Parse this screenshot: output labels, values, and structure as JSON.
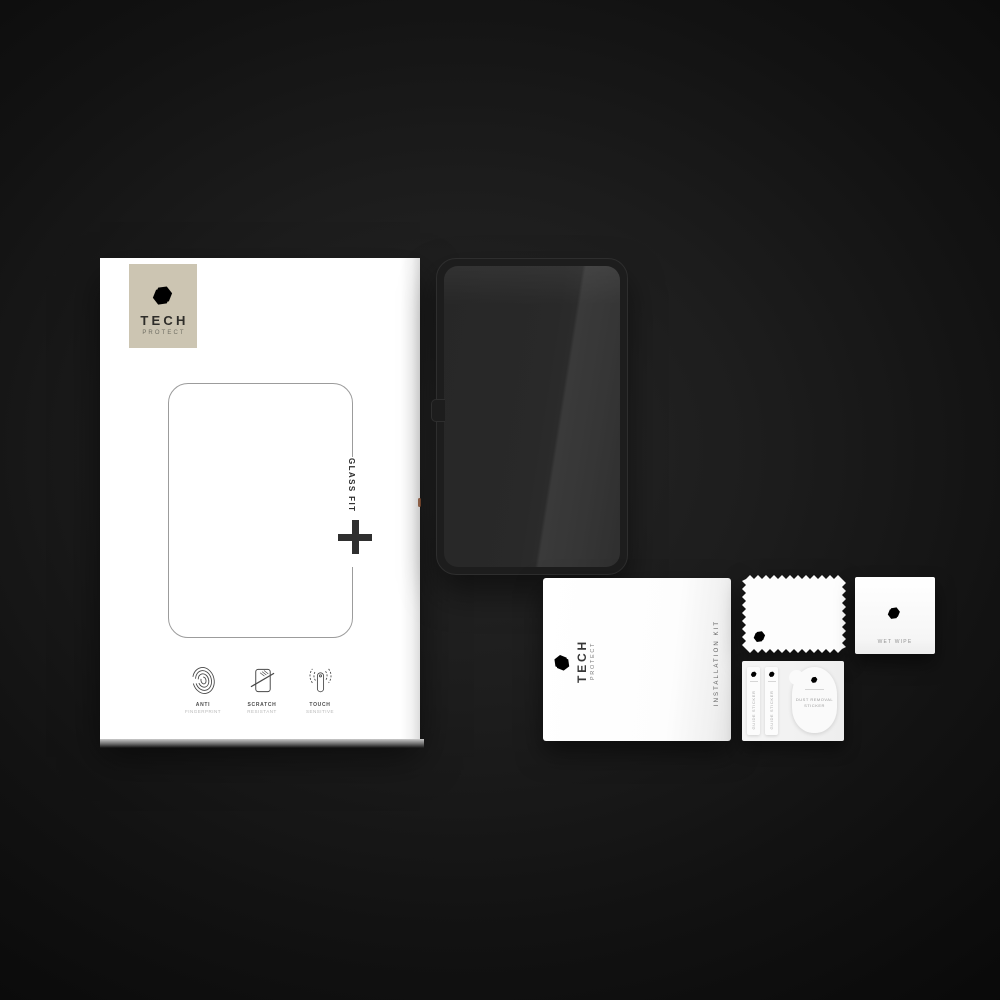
{
  "scene": {
    "description": "Tech-Protect Glass Fit tablet tempered glass kit product photo"
  },
  "box": {
    "brand_line1": "TECH",
    "brand_line2": "PROTECT",
    "product_name": "GLASS FIT",
    "features": [
      {
        "icon": "fingerprint-icon",
        "line1": "ANTI",
        "line2": "FINGERPRINT"
      },
      {
        "icon": "scratch-icon",
        "line1": "SCRATCH",
        "line2": "RESISTANT"
      },
      {
        "icon": "touch-icon",
        "line1": "TOUCH",
        "line2": "SENSITIVE"
      }
    ]
  },
  "installation_kit": {
    "brand_line1": "TECH",
    "brand_line2": "PROTECT",
    "label": "INSTALLATION KIT"
  },
  "wet_wipe": {
    "label": "WET WIPE"
  },
  "sticker_card": {
    "guide_sticker_left": "GUIDE STICKER",
    "guide_sticker_right": "GUIDE STICKER",
    "dust_line1": "DUST REMOVAL",
    "dust_line2": "STICKER"
  },
  "colors": {
    "background_center": "#242424",
    "background_edge": "#070707",
    "box_white": "#ffffff",
    "logo_square_beige": "#ccc5b2",
    "glass_dark": "#2b2b2b",
    "glass_sheen": "#3a3a3a",
    "ink": "#2d2d2d",
    "edge_reflection_orange": "#8a5132"
  }
}
